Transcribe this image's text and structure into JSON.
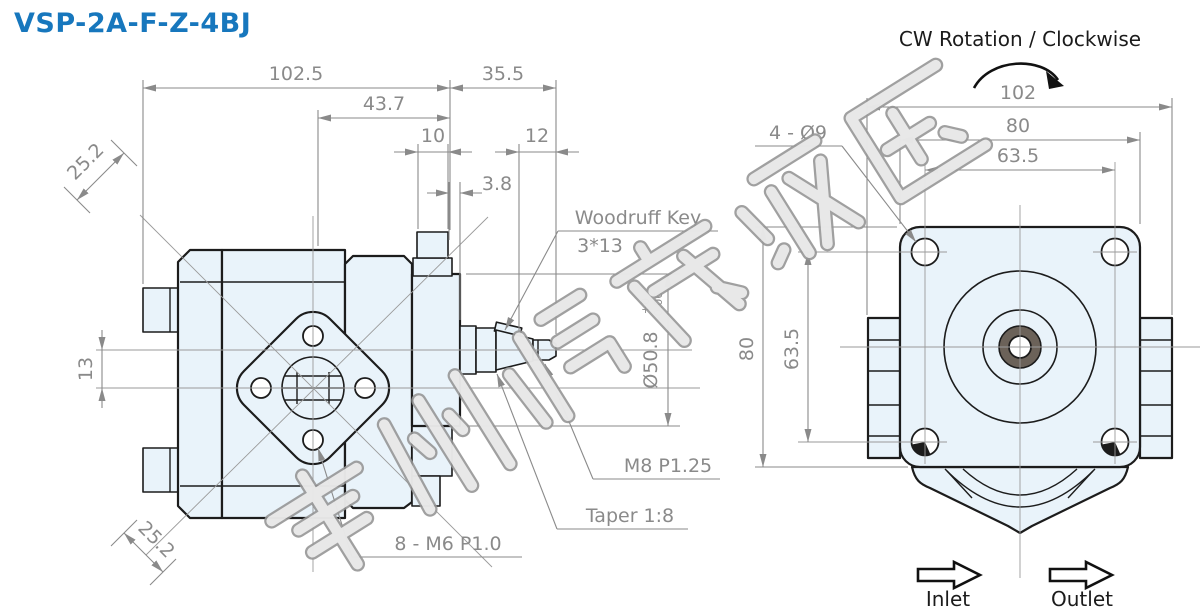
{
  "title": "VSP-2A-F-Z-4BJ",
  "views": {
    "front": {
      "rotation_label": "CW Rotation / Clockwise",
      "inlet_label": "Inlet",
      "outlet_label": "Outlet"
    }
  },
  "dimensions": {
    "side": {
      "overall_length": "102.5",
      "front_section": "43.7",
      "shaft_extension": "35.5",
      "stub_width": "10",
      "thread_length": "12",
      "key_position": "3.8",
      "diag_top": "25.2",
      "diag_bottom": "25.2",
      "port_offset": "13",
      "pilot_dia": "Ø50.8",
      "pilot_tol_upper": "+0",
      "pilot_tol_lower": "-0.06"
    },
    "front": {
      "overall_width": "102",
      "flange_width": "80",
      "bolt_spacing_w": "63.5",
      "flange_height": "80",
      "bolt_spacing_h": "63.5",
      "mount_holes": "4 - Ø9"
    }
  },
  "callouts": {
    "woodruff_key": "Woodruff Key",
    "woodruff_key_size": "3*13",
    "thread_spec": "M8  P1.25",
    "taper_spec": "Taper 1:8",
    "flange_thread_spec": "8 - M6 P1.0"
  },
  "watermark": {
    "text": "常州鸿茂液压"
  },
  "colors": {
    "accent": "#1777BD",
    "body_fill": "#E9F3FA",
    "outline": "#1C1C1C",
    "dimension_gray": "#8A8A8A",
    "shaft_bore_ring": "#6B6259"
  }
}
